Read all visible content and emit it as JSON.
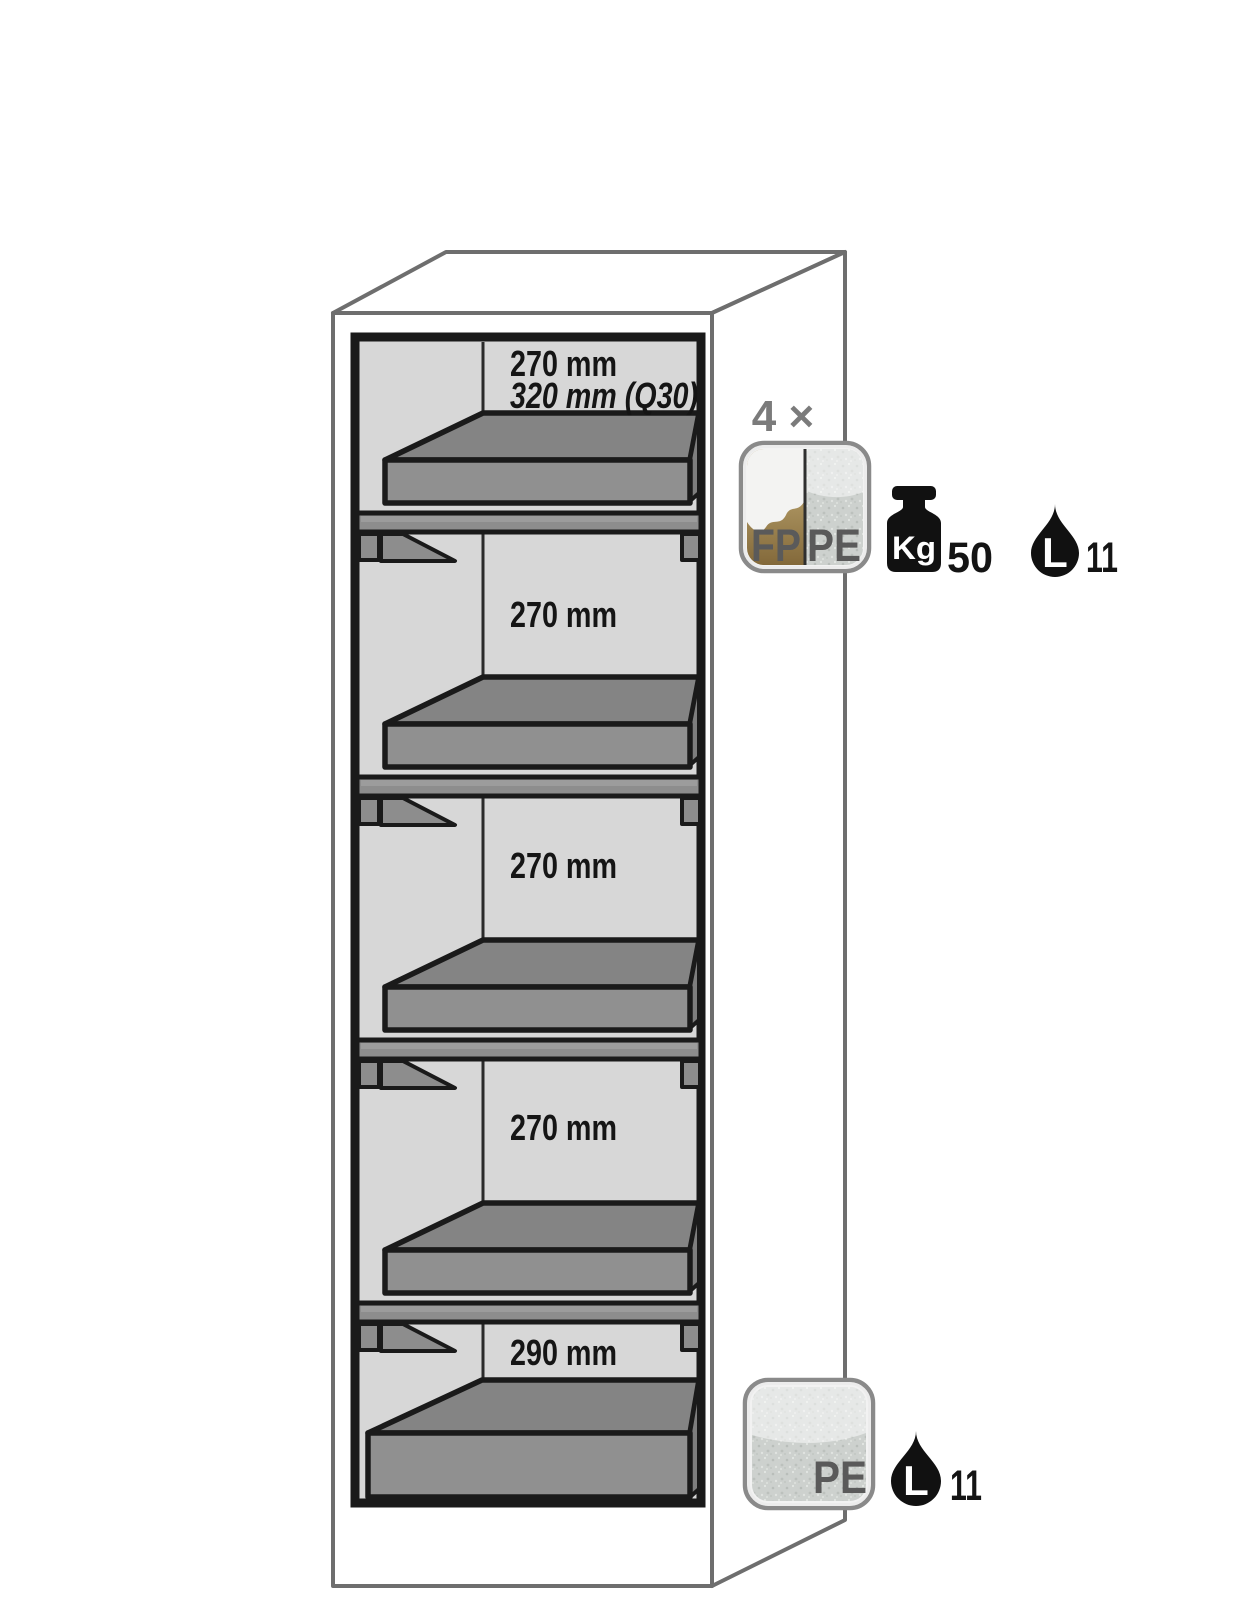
{
  "diagram": {
    "title": "safety-cabinet-interior-equipment-diagram",
    "compartments": [
      {
        "height_label": "270 mm",
        "height_label_q30": "320 mm (Q30)"
      },
      {
        "height_label": "270 mm"
      },
      {
        "height_label": "270 mm"
      },
      {
        "height_label": "270 mm"
      },
      {
        "height_label": "290 mm"
      }
    ],
    "shelf_annotation": {
      "quantity": "4 ×",
      "material_left": "FP",
      "material_right": "PE",
      "load_unit": "Kg",
      "load_value": "50",
      "volume_unit": "L",
      "volume_value": "11"
    },
    "sump_annotation": {
      "material": "PE",
      "volume_unit": "L",
      "volume_value": "11"
    },
    "colors": {
      "interior_gray": "#d7d7d7",
      "tray_top_gray": "#848484",
      "tray_front_gray": "#909090",
      "steel_gray": "#8d8d8d",
      "outline_black": "#1a1a1a",
      "cabinet_line_gray": "#6e6e6e",
      "quantity_gray": "#7b7b7b",
      "badge_gold": "#a78f5c",
      "badge_galvanized": "#cdd1ce",
      "icon_black": "#111111"
    }
  }
}
